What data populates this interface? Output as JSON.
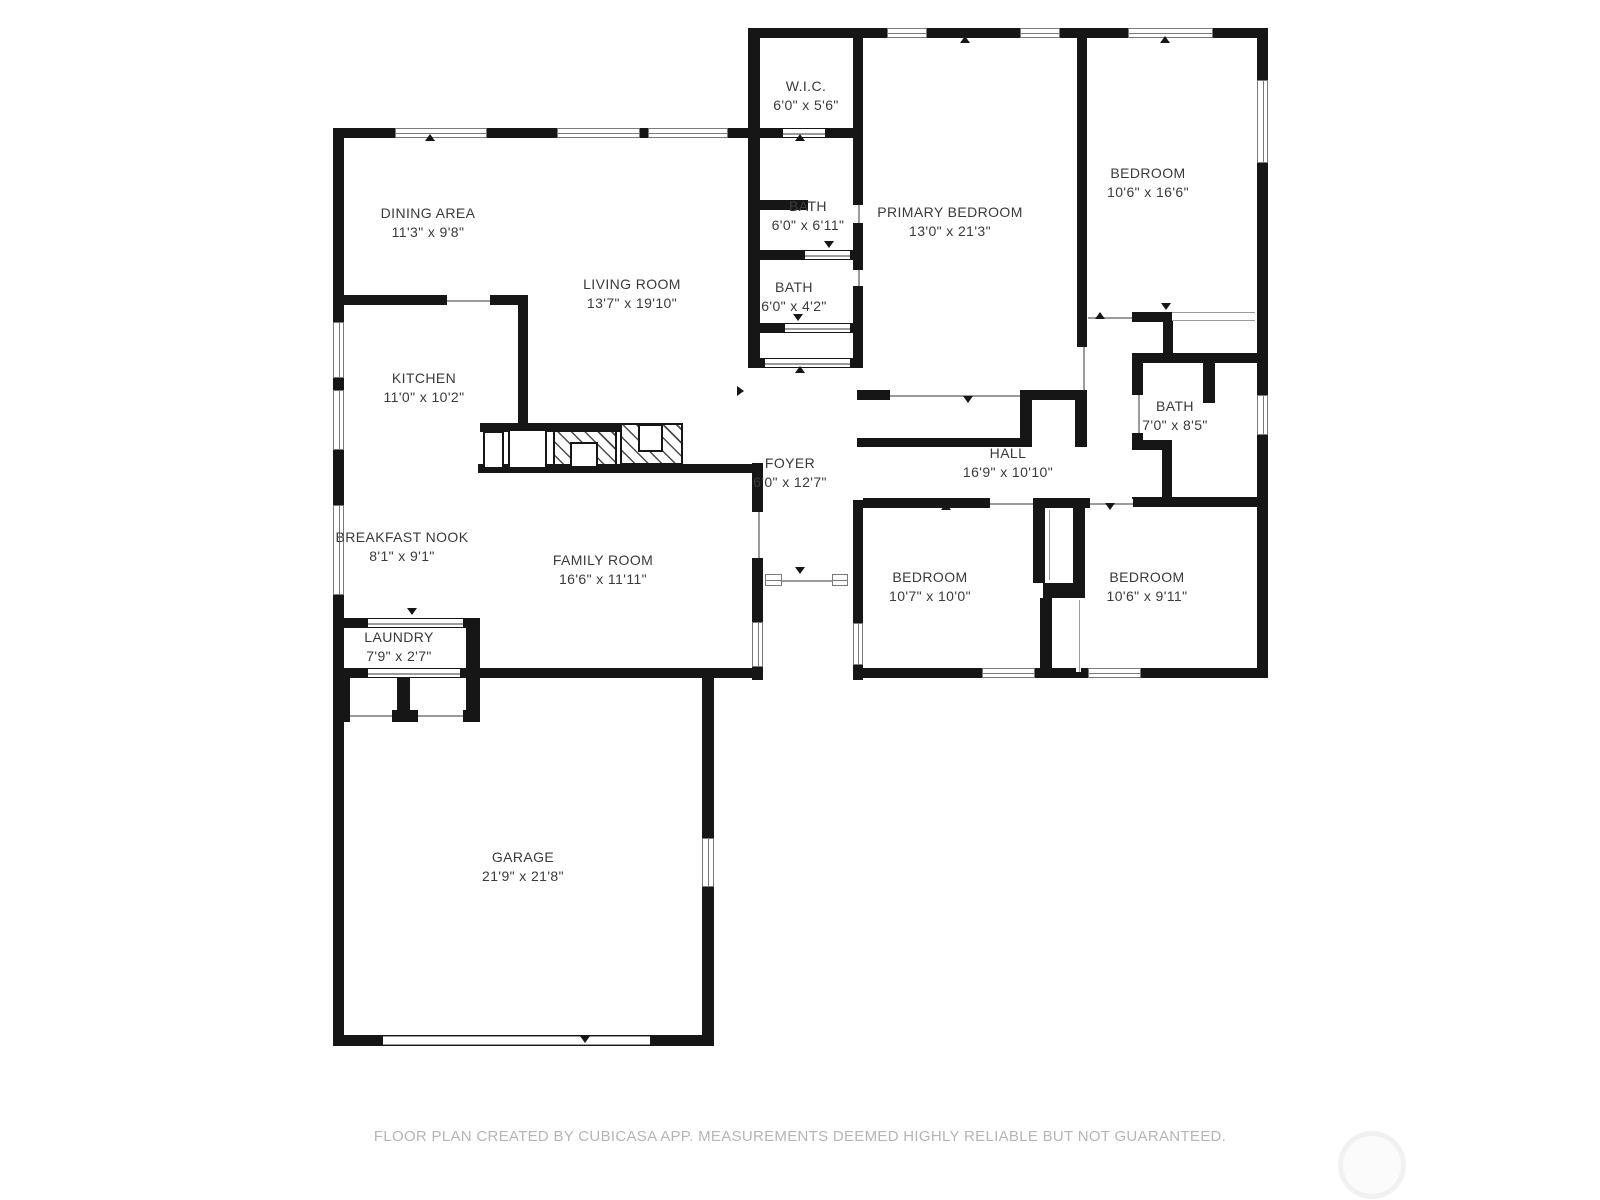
{
  "plan": {
    "app_credit": "FLOOR PLAN CREATED BY CUBICASA APP. MEASUREMENTS DEEMED HIGHLY RELIABLE BUT NOT GUARANTEED.",
    "colors": {
      "wall": "#161616",
      "label": "#3a3a3a",
      "footer_text": "#b5b5b5",
      "opening_line": "#9b9b9b",
      "background": "#ffffff"
    }
  },
  "rooms": [
    {
      "id": "wic",
      "name": "W.I.C.",
      "dims": "6'0\" x 5'6\""
    },
    {
      "id": "dining-area",
      "name": "DINING AREA",
      "dims": "11'3\" x 9'8\""
    },
    {
      "id": "bath-ensuite",
      "name": "BATH",
      "dims": "6'0\" x 6'11\""
    },
    {
      "id": "primary-bedroom",
      "name": "PRIMARY BEDROOM",
      "dims": "13'0\" x 21'3\""
    },
    {
      "id": "bedroom-top-right",
      "name": "BEDROOM",
      "dims": "10'6\" x 16'6\""
    },
    {
      "id": "living-room",
      "name": "LIVING ROOM",
      "dims": "13'7\" x 19'10\""
    },
    {
      "id": "bath-small",
      "name": "BATH",
      "dims": "6'0\" x 4'2\""
    },
    {
      "id": "kitchen",
      "name": "KITCHEN",
      "dims": "11'0\" x 10'2\""
    },
    {
      "id": "bath-hall",
      "name": "BATH",
      "dims": "7'0\" x 8'5\""
    },
    {
      "id": "foyer",
      "name": "FOYER",
      "dims": "6'0\" x 12'7\""
    },
    {
      "id": "hall",
      "name": "HALL",
      "dims": "16'9\" x 10'10\""
    },
    {
      "id": "breakfast-nook",
      "name": "BREAKFAST NOOK",
      "dims": "8'1\" x 9'1\""
    },
    {
      "id": "family-room",
      "name": "FAMILY ROOM",
      "dims": "16'6\" x 11'11\""
    },
    {
      "id": "bedroom-bottom-left",
      "name": "BEDROOM",
      "dims": "10'7\" x 10'0\""
    },
    {
      "id": "bedroom-bottom-right",
      "name": "BEDROOM",
      "dims": "10'6\" x 9'11\""
    },
    {
      "id": "laundry",
      "name": "LAUNDRY",
      "dims": "7'9\" x 2'7\""
    },
    {
      "id": "garage",
      "name": "GARAGE",
      "dims": "21'9\" x 21'8\""
    }
  ],
  "footer": {
    "text": "FLOOR PLAN CREATED BY CUBICASA APP. MEASUREMENTS DEEMED HIGHLY RELIABLE BUT NOT GUARANTEED."
  }
}
